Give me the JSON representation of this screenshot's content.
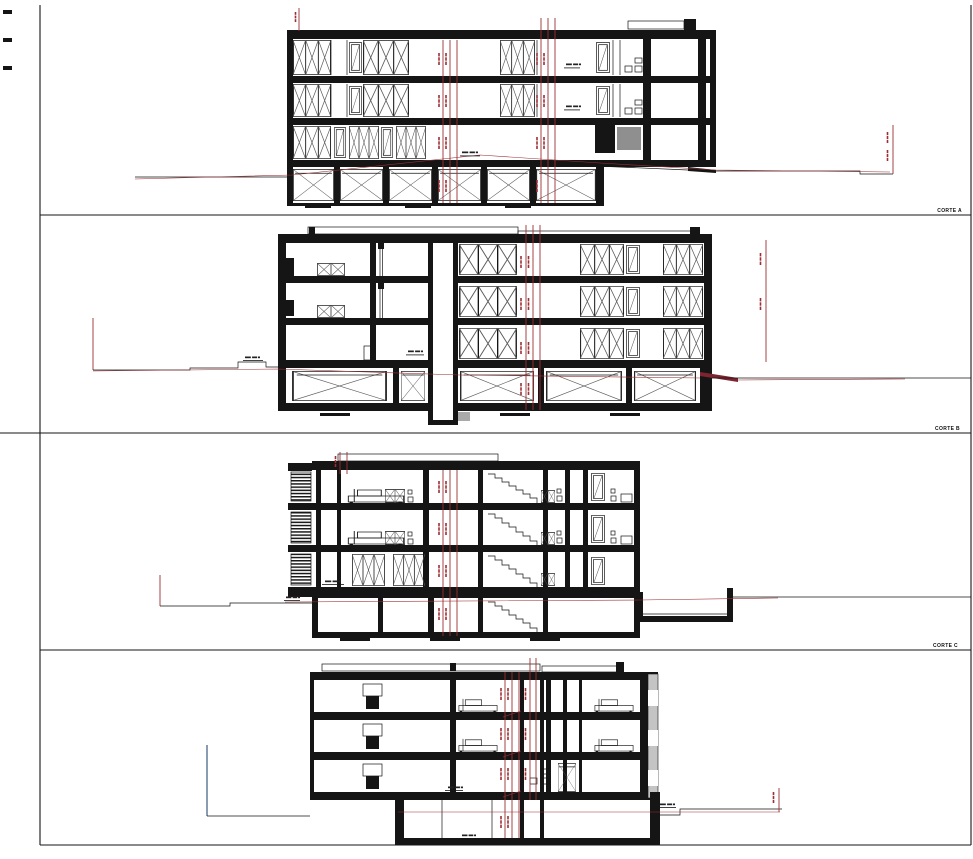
{
  "sheet": {
    "background": "#ffffff",
    "ink_color": "#151515",
    "dimension_color": "#9c2f33",
    "terrain_marker_blue": "#3d5b7d",
    "panels": [
      {
        "id": "corte-a",
        "label": "CORTE A"
      },
      {
        "id": "corte-b",
        "label": "CORTE B"
      },
      {
        "id": "corte-c",
        "label": "CORTE C"
      },
      {
        "id": "corte-d"
      }
    ]
  }
}
